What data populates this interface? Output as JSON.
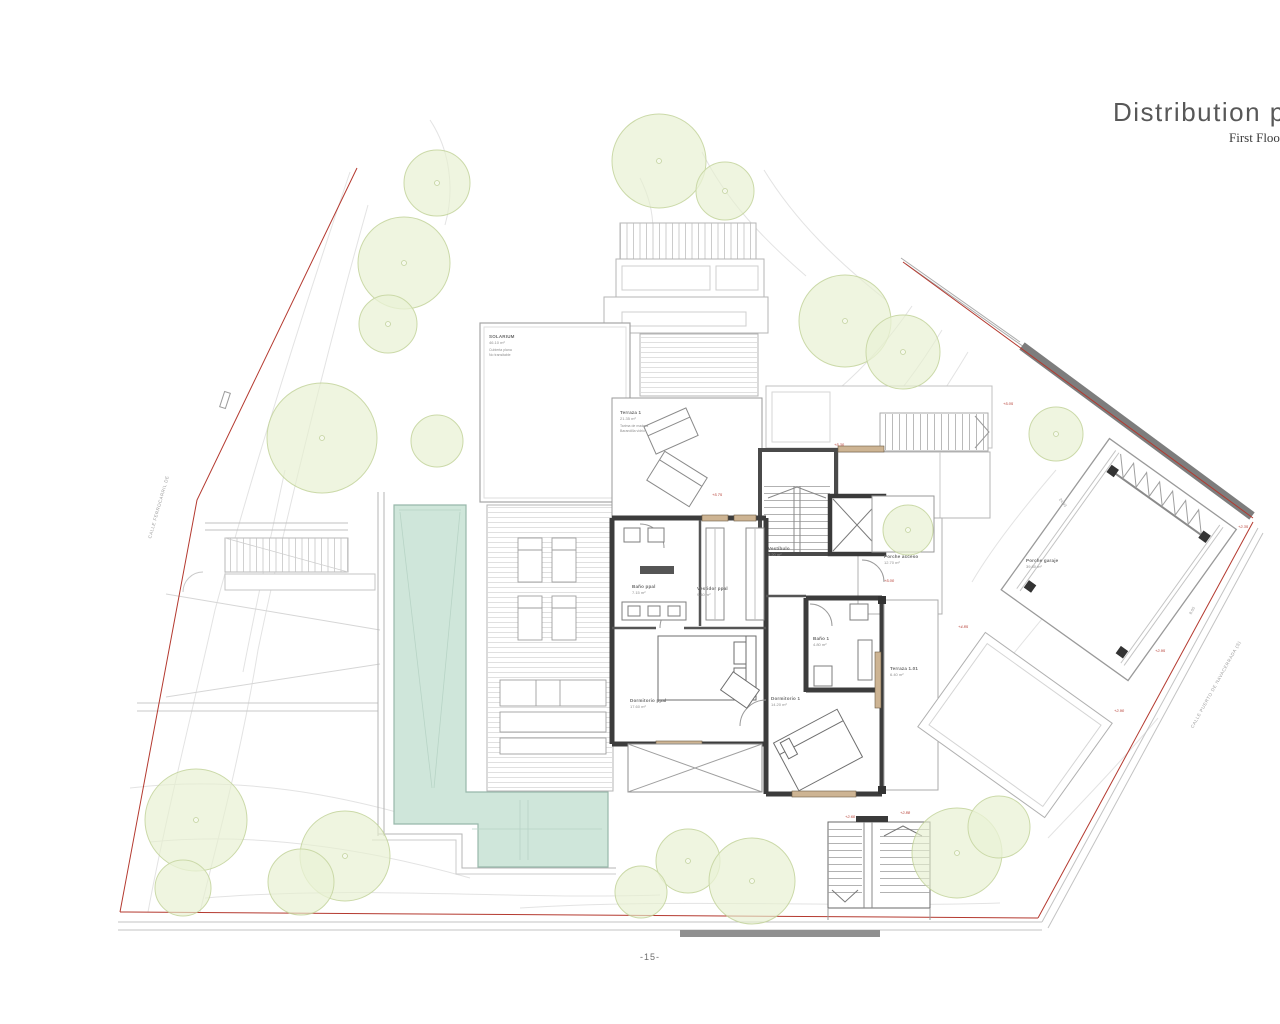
{
  "titleblock": {
    "title": "Distribution plan",
    "subtitle": "First Floor"
  },
  "page_number": "-15-",
  "streets": {
    "left": "CALLE FERROCARRIL DE",
    "right": "CALLE PUERTO DE NAVACERRADA (S)"
  },
  "rooms": {
    "solarium": {
      "name": "SOLARIUM",
      "area": "46.10 m²",
      "note1": "Cubierta plana",
      "note2": "No transitable"
    },
    "terraza1": {
      "name": "Terraza 1",
      "area": "21.35 m²",
      "note1": "Tarima de madera",
      "note2": "Barandilla vidrio"
    },
    "bano_ppal": {
      "name": "Baño ppal",
      "area": "7.15 m²"
    },
    "vestidor_ppal": {
      "name": "Vestidor ppal",
      "area": "9.40 m²"
    },
    "vestibulo": {
      "name": "Vestíbulo",
      "area": "5.20 m²"
    },
    "dormitorio_ppal": {
      "name": "Dormitorio ppal",
      "area": "17.60 m²"
    },
    "dormitorio1": {
      "name": "Dormitorio 1",
      "area": "14.20 m²"
    },
    "bano1": {
      "name": "Baño 1",
      "area": "4.80 m²"
    },
    "terraza_d1": {
      "name": "Terraza 1.01",
      "area": "6.40 m²"
    },
    "porche_acceso": {
      "name": "Porche acceso",
      "area": "12.70 m²"
    },
    "porche_garaje": {
      "name": "Porche garaje",
      "area": "39.80 m²"
    }
  },
  "levels": [
    {
      "v": "+5.75"
    },
    {
      "v": "+5.30"
    },
    {
      "v": "+5.00"
    },
    {
      "v": "+4.85"
    },
    {
      "v": "+5.05"
    },
    {
      "v": "+2.60"
    },
    {
      "v": "+2.88"
    },
    {
      "v": "+2.95"
    },
    {
      "v": "+2.90"
    },
    {
      "v": "+2.35"
    }
  ],
  "dims": [
    {
      "v": "24.93"
    },
    {
      "v": "8.05"
    }
  ],
  "colors": {
    "tree_fill": "#e7f0cf",
    "tree_stroke": "#c2d39a",
    "pool_fill": "#cfe6da",
    "boundary_red": "#b4392f",
    "wall_dark": "#3a3a3a",
    "window_tan": "#cdb493"
  }
}
